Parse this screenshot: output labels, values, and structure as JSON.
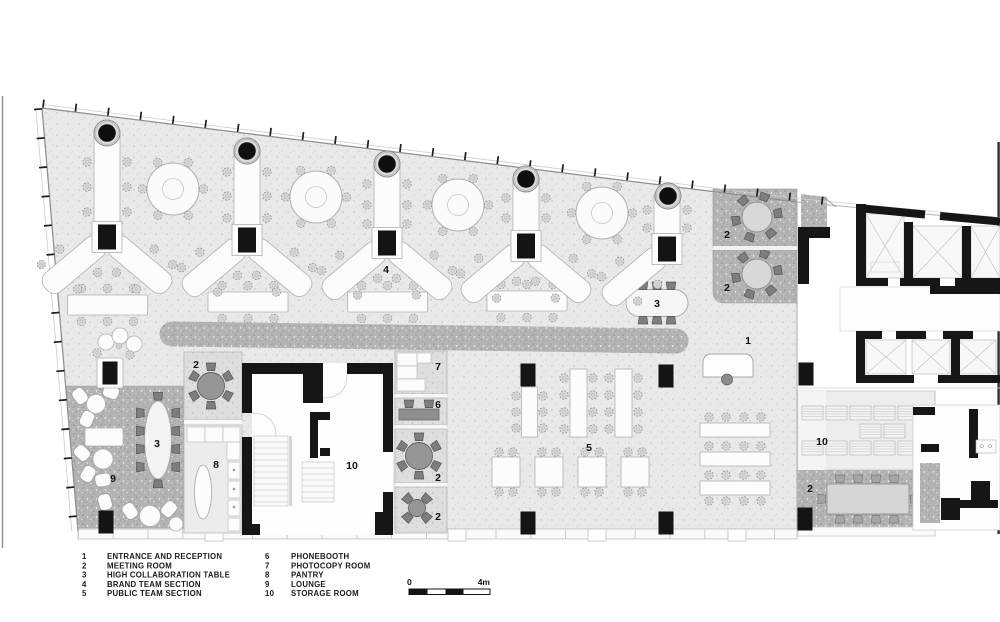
{
  "legend": {
    "col1": [
      {
        "number": "1",
        "label": "ENTRANCE AND RECEPTION"
      },
      {
        "number": "2",
        "label": "MEETING ROOM"
      },
      {
        "number": "3",
        "label": "HIGH COLLABORATION TABLE"
      },
      {
        "number": "4",
        "label": "BRAND TEAM SECTION"
      },
      {
        "number": "5",
        "label": "PUBLIC TEAM SECTION"
      }
    ],
    "col2": [
      {
        "number": "6",
        "label": "PHONEBOOTH"
      },
      {
        "number": "7",
        "label": "PHOTOCOPY ROOM"
      },
      {
        "number": "8",
        "label": "PANTRY"
      },
      {
        "number": "9",
        "label": "LOUNGE"
      },
      {
        "number": "10",
        "label": "STORAGE ROOM"
      }
    ]
  },
  "scale_bar": {
    "start_label": "0",
    "end_label": "4m"
  },
  "plan": {
    "room_labels": [
      "1",
      "2",
      "2",
      "2",
      "2",
      "2",
      "2",
      "3",
      "3",
      "4",
      "5",
      "6",
      "7",
      "8",
      "9",
      "10",
      "10"
    ],
    "colors": {
      "wall": "#161616",
      "floor_light": "#e9e9e8",
      "floor_dark": "#b5b5b4"
    }
  }
}
